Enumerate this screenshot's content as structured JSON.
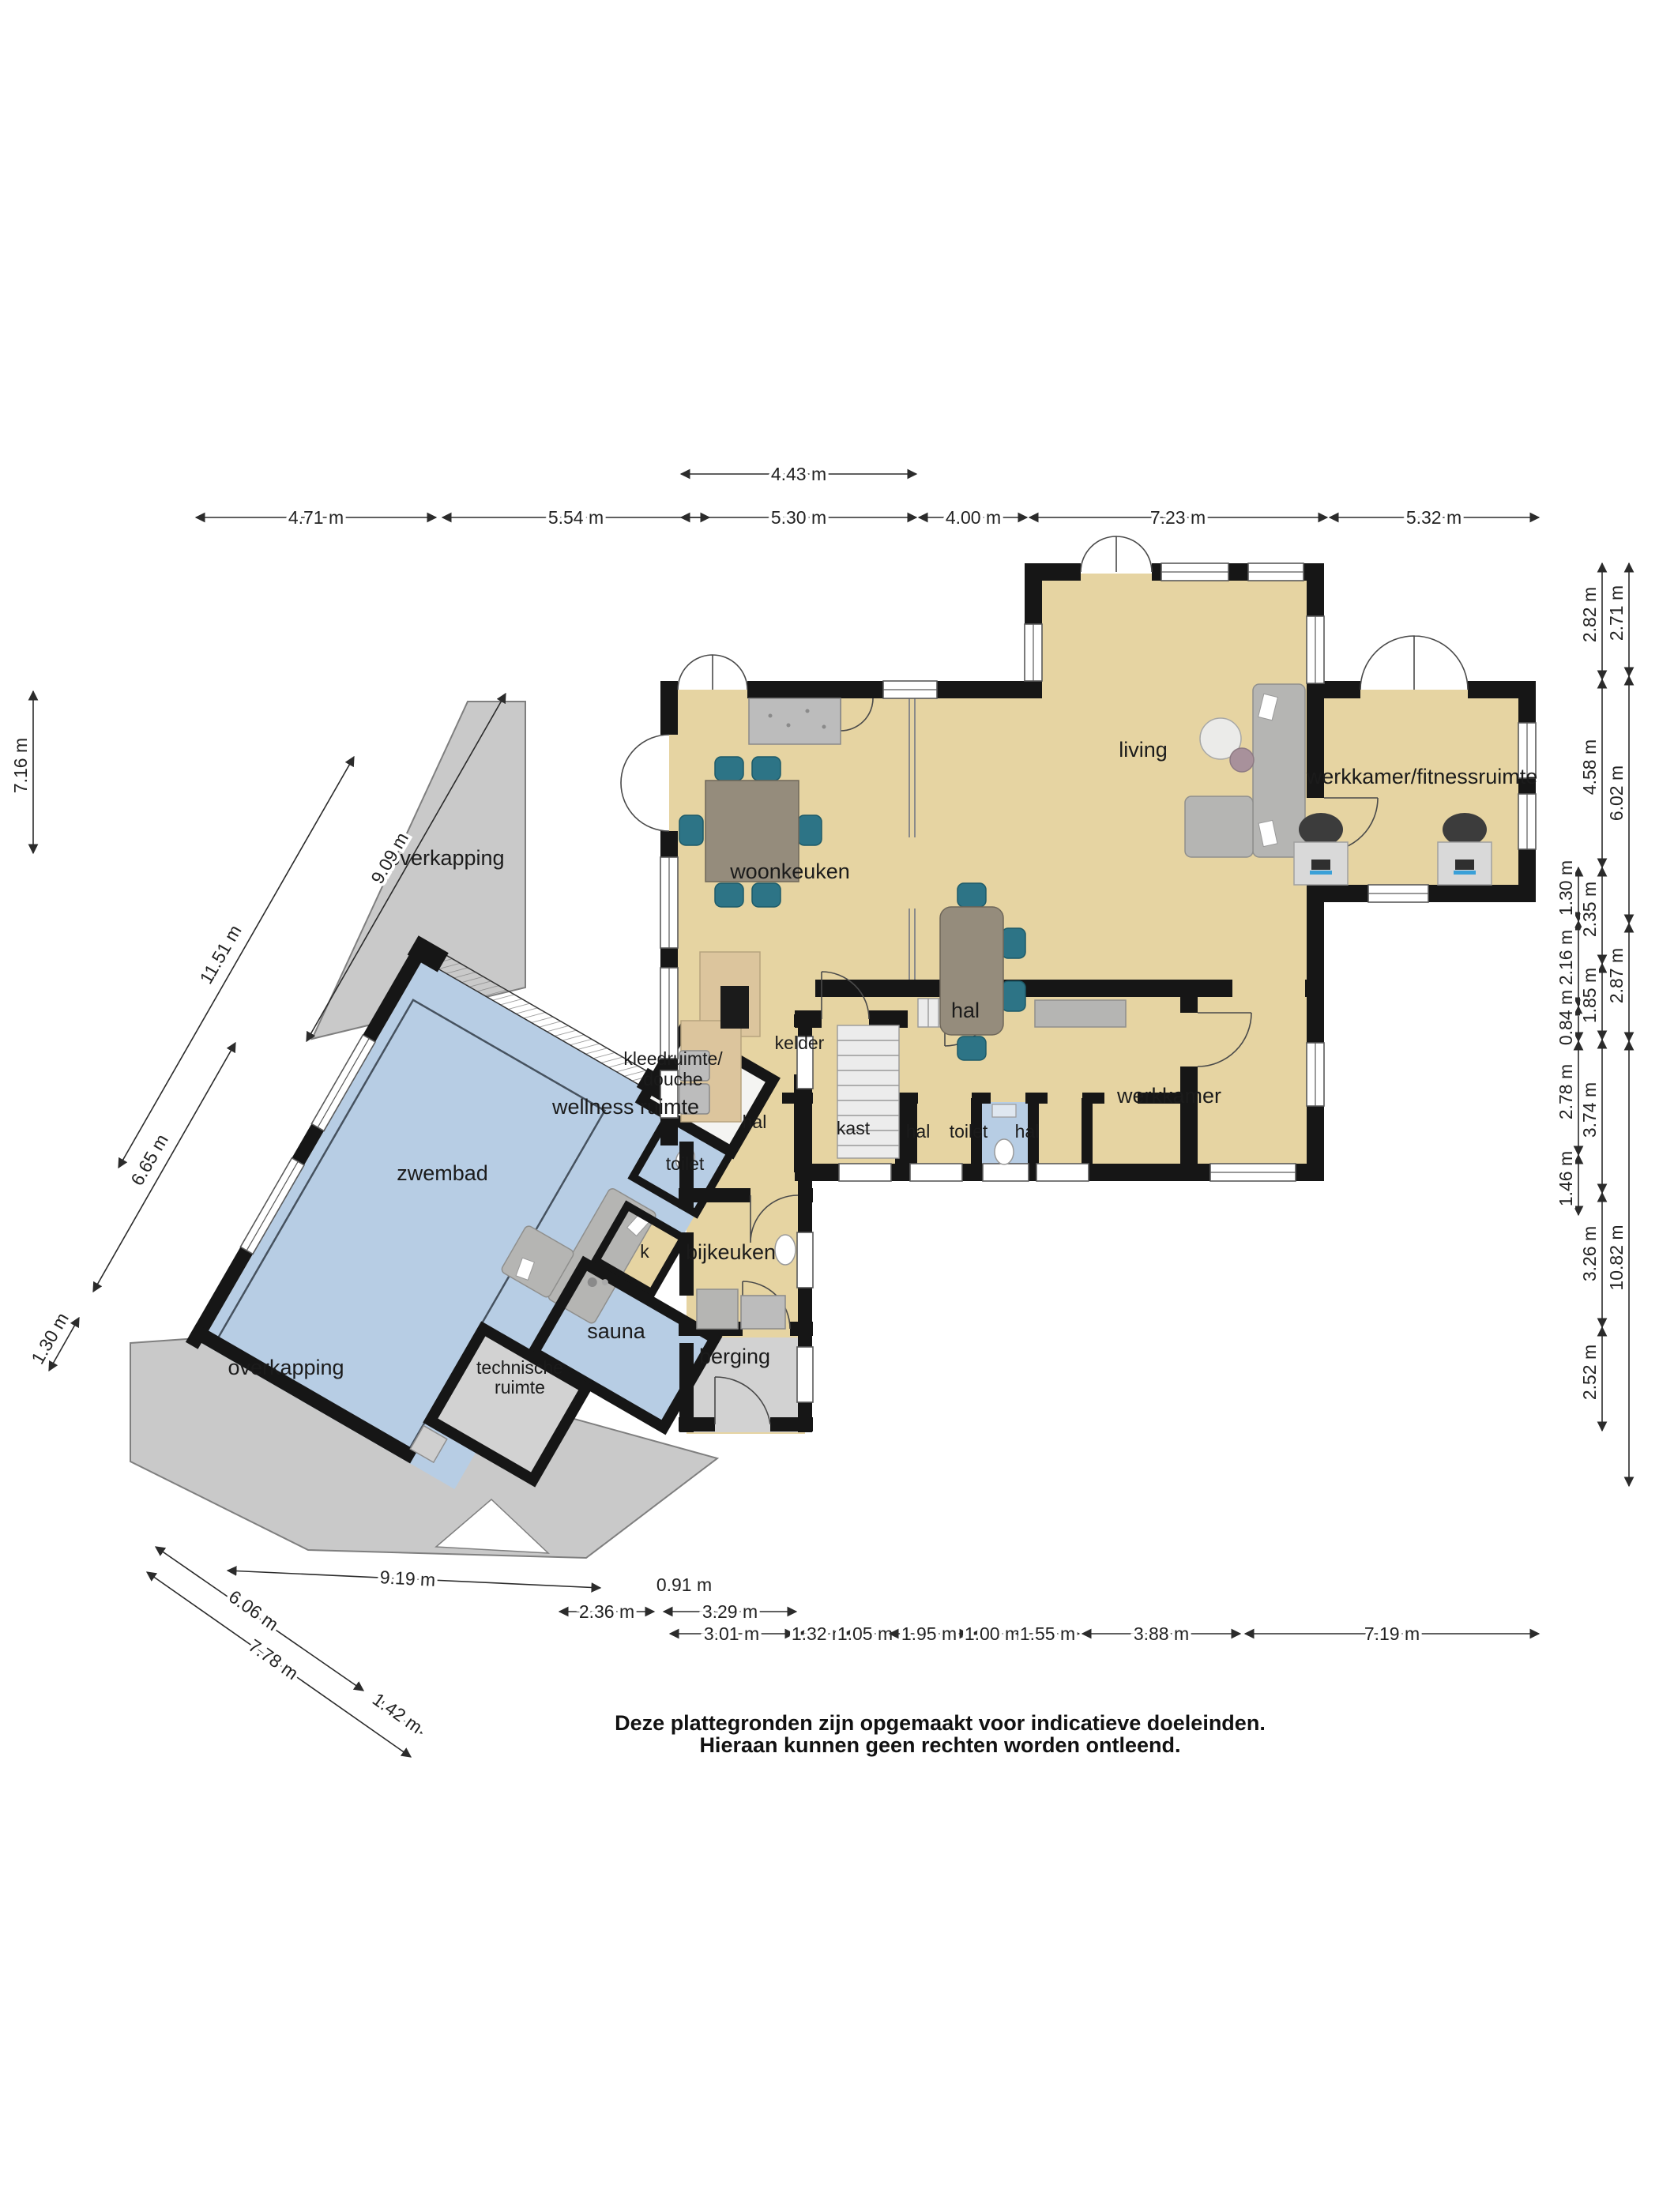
{
  "disclaimer": {
    "line1": "Deze plattegronden zijn opgemaakt voor indicatieve doeleinden.",
    "line2": "Hieraan kunnen geen rechten worden ontleend."
  },
  "rooms": {
    "overkapping_top": "overkapping",
    "overkapping_bottom": "overkapping",
    "woonkeuken": "woonkeuken",
    "living": "living",
    "werkkamer_fitnessruimte": "werkkamer/fitnessruimte",
    "hal_main": "hal",
    "kelder": "kelder",
    "kast": "kast",
    "hal_small_left": "hal",
    "toilet_main": "toilet",
    "hal_small_right": "hal",
    "werkkamer": "werkkamer",
    "kleedruimte_line1": "kleedruimte/",
    "kleedruimte_line2": "douche",
    "wellness": "wellness ruimte",
    "zwembad": "zwembad",
    "toilet_pool": "toilet",
    "hal_wing": "hal",
    "k": "k",
    "bijkeuken": "bijkeuken",
    "sauna": "sauna",
    "technische_line1": "technische",
    "technische_line2": "ruimte",
    "berging": "berging"
  },
  "dims": {
    "top_single": "4.43 m",
    "top_row": [
      "4.71 m",
      "5.54 m",
      "5.30 m",
      "4.00 m",
      "7.23 m",
      "5.32 m"
    ],
    "right_inner": [
      "1.30 m",
      "2.16 m",
      "0.84 m",
      "2.78 m",
      "1.46 m"
    ],
    "right_mid": [
      "2.82 m",
      "4.58 m",
      "2.35 m",
      "1.85 m",
      "3.74 m",
      "3.26 m",
      "2.52 m"
    ],
    "right_outer": [
      "2.71 m",
      "6.02 m",
      "2.87 m",
      "10.82 m"
    ],
    "left_vertical": "7.16 m",
    "left_diag": [
      "9.09 m",
      "11.51 m",
      "6.65 m",
      "1.30 m"
    ],
    "bottom_diag": [
      "9.19 m",
      "6.06 m",
      "7.78 m",
      "1.42 m"
    ],
    "bottom_small": "0.91 m",
    "bottom_row2": [
      "2.36 m",
      "3.29 m"
    ],
    "bottom_row3": [
      "3.01 m",
      "1.32 m",
      "1.05 m",
      "1.95 m",
      "1.00 m",
      "1.55 m",
      "3.88 m",
      "7.19 m"
    ]
  },
  "colors": {
    "floor_tan": "#e6d4a2",
    "pool_blue": "#b7cde4",
    "wall_black": "#161616",
    "overkapping_grey": "#c9c9c9",
    "storage_grey": "#d2d2d2",
    "chair_teal": "#2d7486",
    "furniture_grey": "#b5b5b3"
  }
}
